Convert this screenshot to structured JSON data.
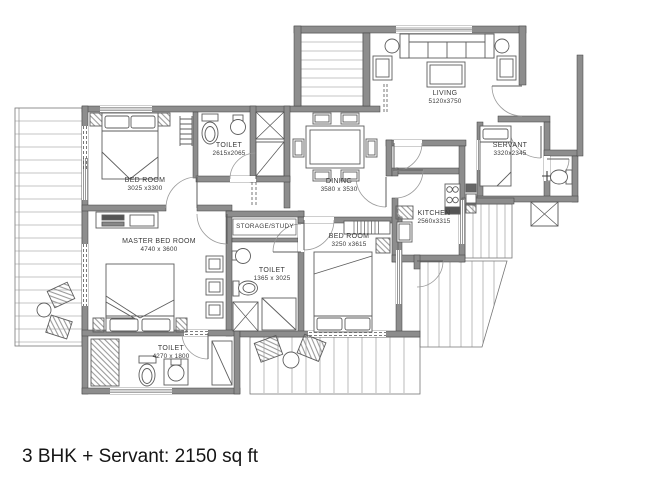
{
  "caption": "3 BHK + Servant: 2150 sq ft",
  "plan": {
    "rooms": [
      {
        "name": "LIVING",
        "dims": "5120x3750"
      },
      {
        "name": "DINING",
        "dims": "3580 x 3530"
      },
      {
        "name": "BED ROOM",
        "dims": "3025 x3300"
      },
      {
        "name": "TOILET",
        "dims": "2615x2065"
      },
      {
        "name": "SERVANT",
        "dims": "3320x2345"
      },
      {
        "name": "KITCHEN",
        "dims": "2560x3315"
      },
      {
        "name": "MASTER BED ROOM",
        "dims": "4740 x 3600"
      },
      {
        "name": "STORAGE/STUDY",
        "dims": ""
      },
      {
        "name": "TOILET",
        "dims": "1365 x 3025"
      },
      {
        "name": "BED ROOM",
        "dims": "3250 x3615"
      },
      {
        "name": "TOILET",
        "dims": "4270 x 1800"
      }
    ],
    "colors": {
      "background": "#ffffff",
      "wall": "#8d8d8d",
      "wall_edge": "#3f3f3f",
      "line": "#5d5d5d",
      "label_text": "#3a3a3a",
      "caption_text": "#151515"
    }
  }
}
